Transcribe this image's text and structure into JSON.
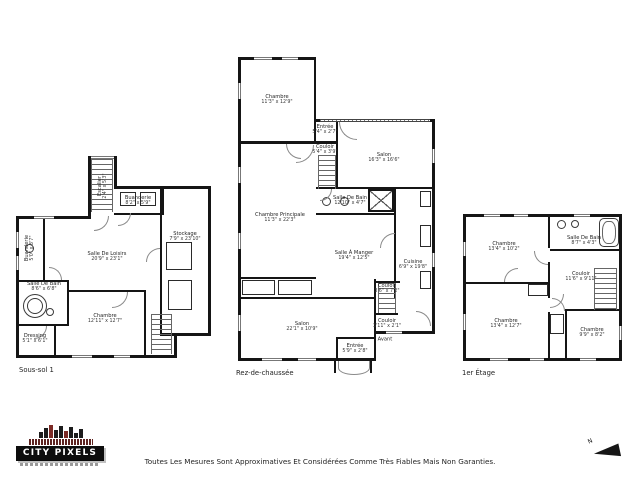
{
  "colors": {
    "wall": "#151515",
    "background": "#ffffff",
    "door_arc": "#8a8a8a",
    "logo_red": "#7c2b26"
  },
  "floors": [
    {
      "label": "Sous-sol 1",
      "rooms": [
        {
          "name": "Escalier",
          "dims": "2'4\" x 5'3\""
        },
        {
          "name": "Buanderie",
          "dims": "8'2\" x 5'9\""
        },
        {
          "name": "Stockage",
          "dims": "7'9\" x 23'10\""
        },
        {
          "name": "Salle De Loisirs",
          "dims": "20'9\" x 23'1\""
        },
        {
          "name": "Buanderie",
          "dims": "5'0\" x 8'7\""
        },
        {
          "name": "Salle De Bain",
          "dims": "8'6\" x 6'8\""
        },
        {
          "name": "Chambre",
          "dims": "12'11\" x 12'7\""
        },
        {
          "name": "Dressing",
          "dims": "5'1\" x 6'1\""
        }
      ]
    },
    {
      "label": "Rez-de-chaussée",
      "rooms": [
        {
          "name": "Chambre",
          "dims": "11'3\" x 12'9\""
        },
        {
          "name": "Entrée",
          "dims": "5'4\" x 2'7\""
        },
        {
          "name": "Couloir",
          "dims": "5'4\" x 3'9\""
        },
        {
          "name": "Salon",
          "dims": "16'3\" x 16'6\""
        },
        {
          "name": "Salle De Bain",
          "dims": "12'10\" x 4'7\""
        },
        {
          "name": "Chambre Principale",
          "dims": "11'3\" x 22'3\""
        },
        {
          "name": "Salle À Manger",
          "dims": "19'4\" x 12'5\""
        },
        {
          "name": "Cuisine",
          "dims": "6'9\" x 19'8\""
        },
        {
          "name": "Couloir",
          "dims": "3'6\" x 7'2\""
        },
        {
          "name": "Couloir",
          "dims": "3'11\" x 2'1\""
        },
        {
          "name": "Avant",
          "dims": ""
        },
        {
          "name": "Salon",
          "dims": "22'1\" x 10'9\""
        },
        {
          "name": "Entrée",
          "dims": "5'9\" x 2'8\""
        }
      ]
    },
    {
      "label": "1er Étage",
      "rooms": [
        {
          "name": "Chambre",
          "dims": "13'4\" x 10'2\""
        },
        {
          "name": "Salle De Bain",
          "dims": "8'7\" x 4'3\""
        },
        {
          "name": "Couloir",
          "dims": "11'6\" x 9'11\""
        },
        {
          "name": "Chambre",
          "dims": "13'4\" x 12'7\""
        },
        {
          "name": "Chambre",
          "dims": "9'9\" x 8'2\""
        }
      ]
    }
  ],
  "footer": {
    "disclaimer": "Toutes Les Mesures Sont Approximatives Et Considérées Comme Très Fiables Mais Non Garanties.",
    "logo_text": "CITY PIXELS",
    "north_label": "N"
  }
}
